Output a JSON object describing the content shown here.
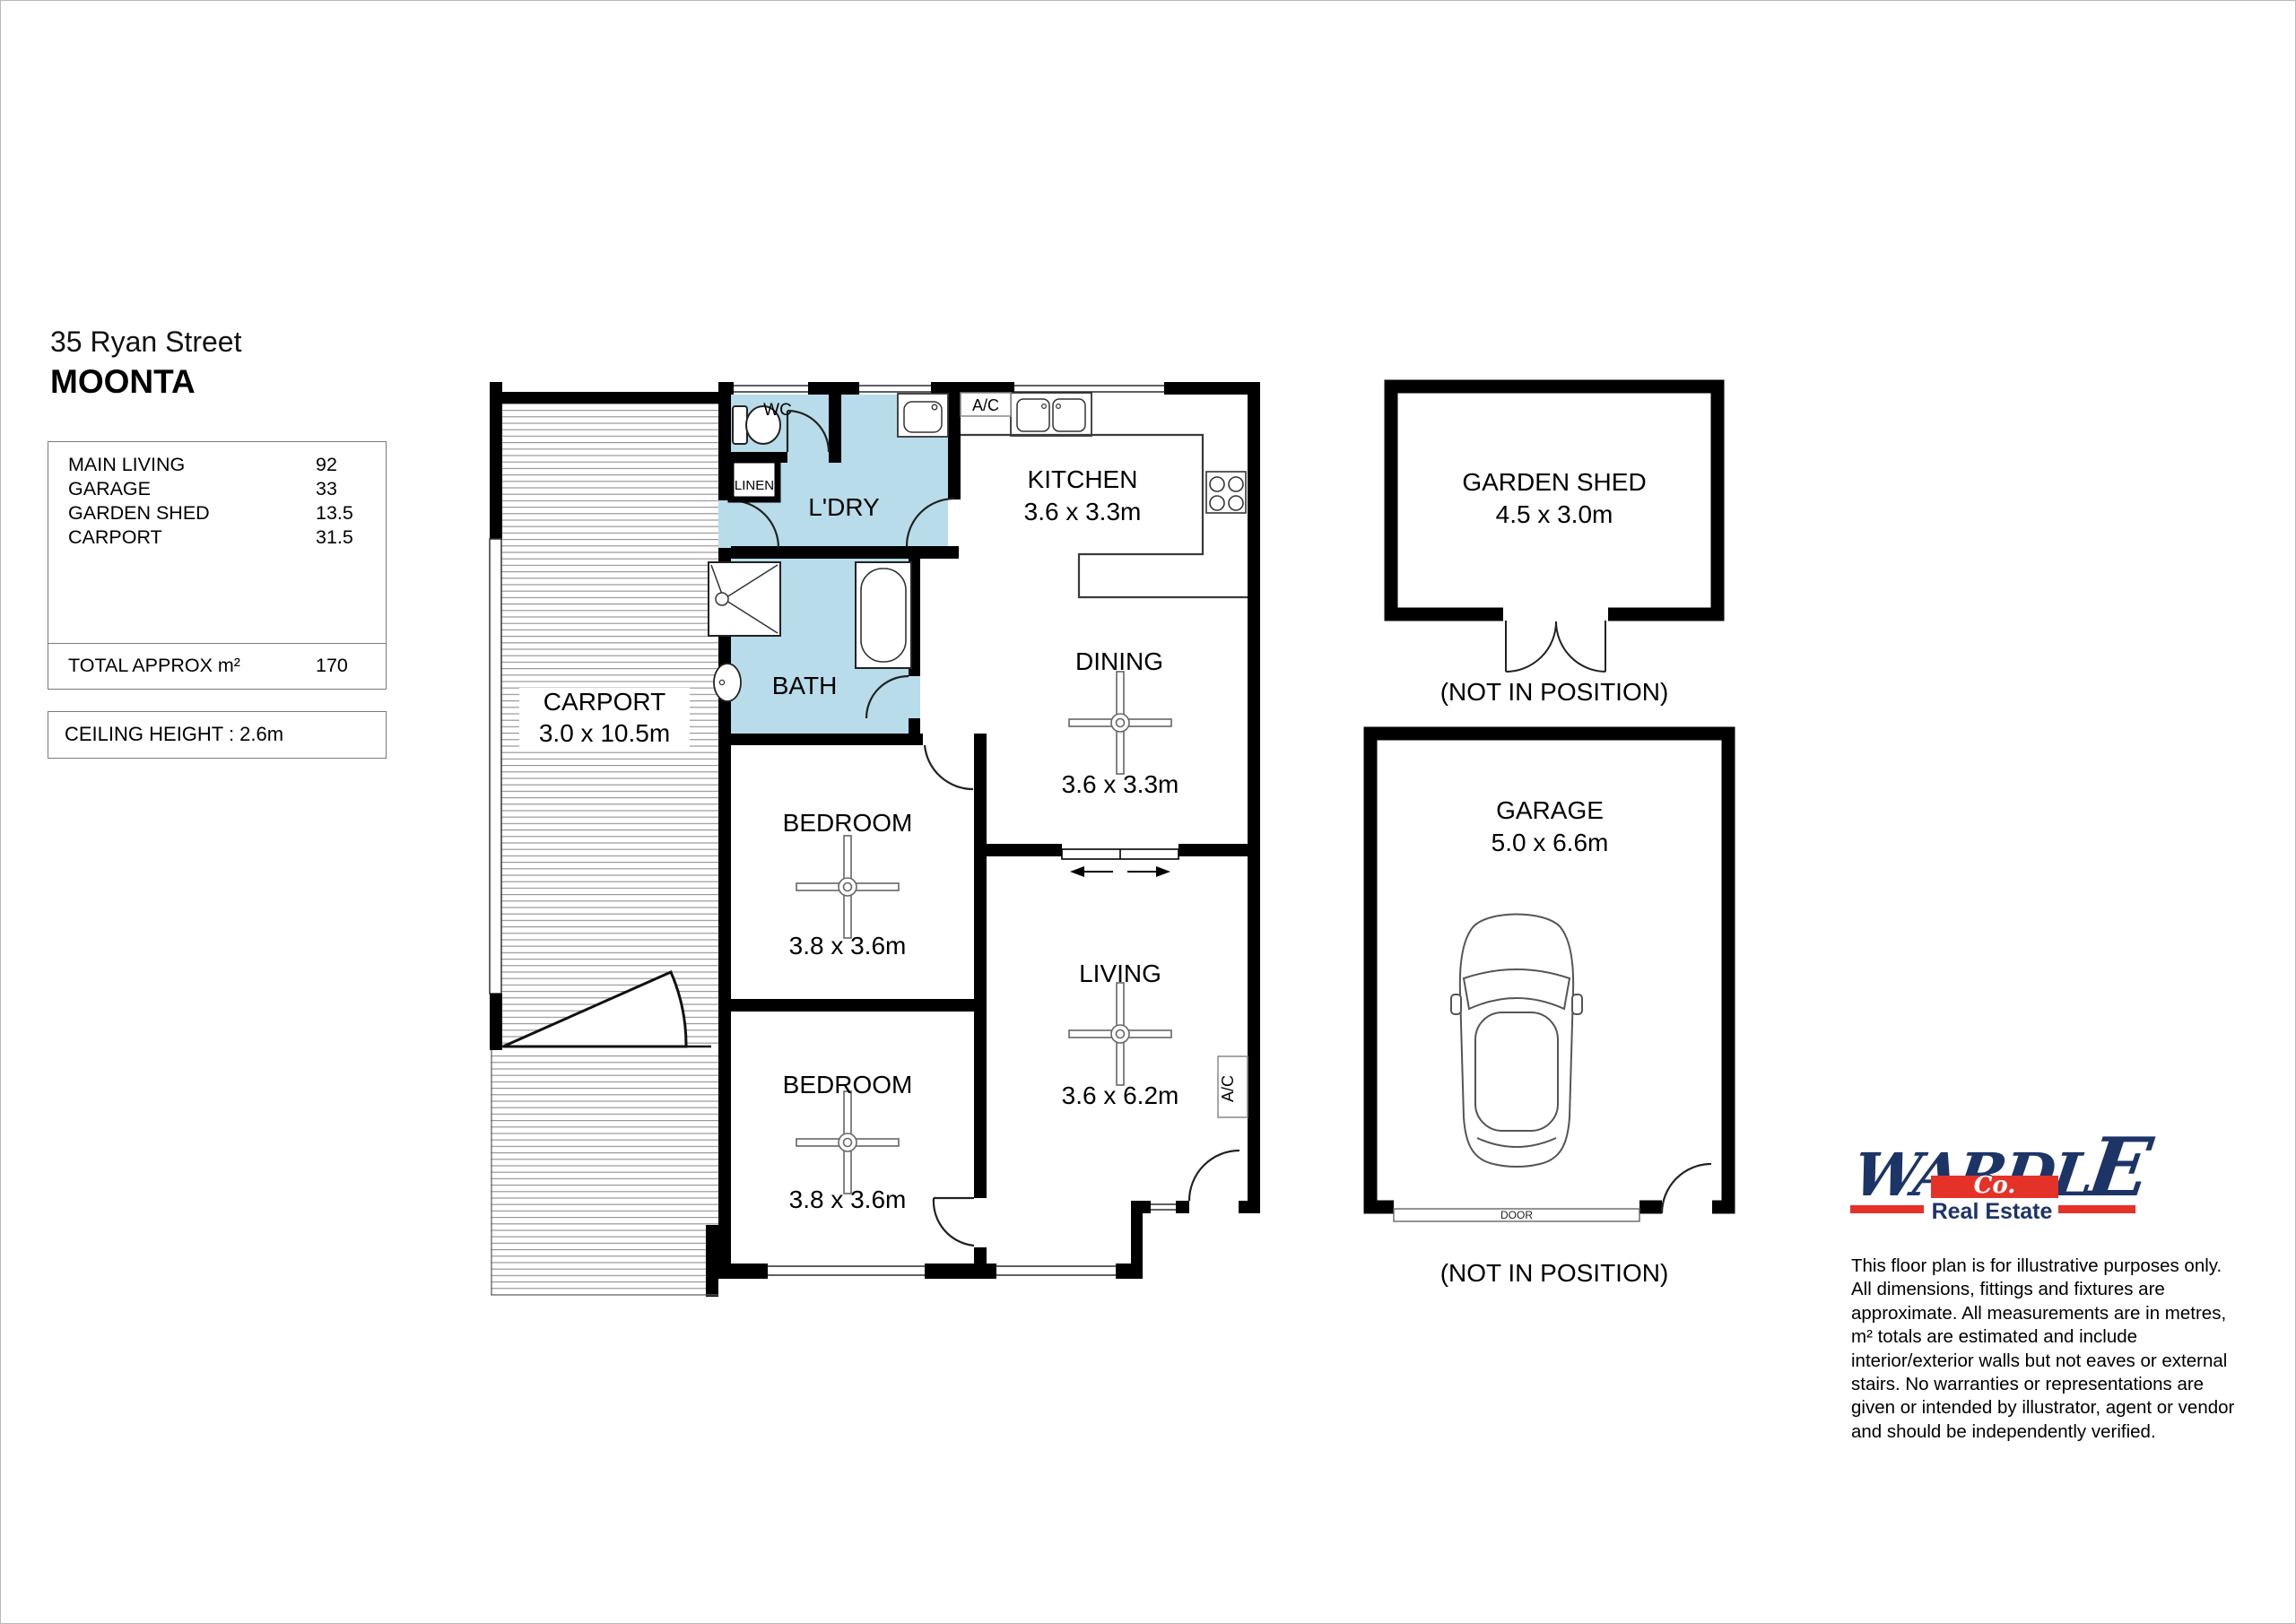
{
  "header": {
    "address_line1": "35 Ryan Street",
    "address_line2": "MOONTA"
  },
  "area_summary": {
    "rows": [
      {
        "label": "MAIN LIVING",
        "value": "92"
      },
      {
        "label": "GARAGE",
        "value": "33"
      },
      {
        "label": "GARDEN SHED",
        "value": "13.5"
      },
      {
        "label": "CARPORT",
        "value": "31.5"
      }
    ],
    "total_label": "TOTAL APPROX m²",
    "total_value": "170"
  },
  "ceiling_height_label": "CEILING HEIGHT : 2.6m",
  "floorplan": {
    "ac_label": "A/C",
    "garage_door_label": "DOOR",
    "not_in_position": "(NOT IN POSITION)",
    "wet_area_color": "#b8dcea",
    "wall_color": "#000000",
    "fixtures": [
      "toilet",
      "laundry-trough",
      "double-sink",
      "cooktop",
      "shower",
      "bathtub",
      "basin",
      "ceiling-fan",
      "car",
      "sliding-door",
      "hinged-door"
    ],
    "rooms": {
      "carport": {
        "name": "CARPORT",
        "dims": "3.0 x 10.5m"
      },
      "wc": {
        "name": "WC"
      },
      "linen": {
        "name": "LINEN"
      },
      "laundry": {
        "name": "L'DRY"
      },
      "bath": {
        "name": "BATH"
      },
      "kitchen": {
        "name": "KITCHEN",
        "dims": "3.6 x 3.3m"
      },
      "dining": {
        "name": "DINING",
        "dims": "3.6 x 3.3m"
      },
      "bedroom1": {
        "name": "BEDROOM",
        "dims": "3.8 x 3.6m"
      },
      "bedroom2": {
        "name": "BEDROOM",
        "dims": "3.8 x 3.6m"
      },
      "living": {
        "name": "LIVING",
        "dims": "3.6 x 6.2m"
      },
      "garden_shed": {
        "name": "GARDEN SHED",
        "dims": "4.5 x 3.0m"
      },
      "garage": {
        "name": "GARAGE",
        "dims": "5.0 x 6.6m"
      }
    }
  },
  "logo": {
    "brand_start": "WARDL",
    "brand_end": "E",
    "co": "Co.",
    "tagline": "Real Estate",
    "navy": "#1d3467",
    "red": "#e53229"
  },
  "disclaimer": {
    "lines": [
      "This floor plan is for illustrative purposes only.",
      "All dimensions, fittings and fixtures are",
      "approximate. All measurements are in metres,",
      "m² totals are estimated and include",
      "interior/exterior walls but not eaves or external",
      "stairs. No warranties or representations are",
      "given or intended by illustrator, agent or vendor",
      "and should be independently verified."
    ]
  }
}
